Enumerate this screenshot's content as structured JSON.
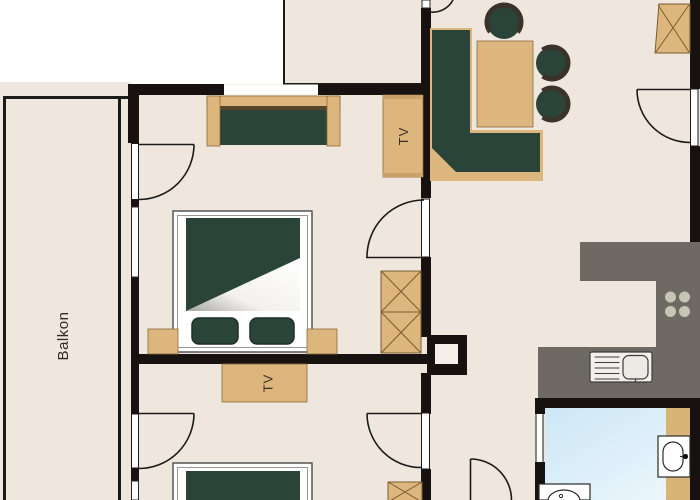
{
  "plan": {
    "type": "apartment-floorplan",
    "labels": {
      "balcony": "Balkon",
      "tv_bedroom1": "TV",
      "tv_bedroom2": "TV"
    },
    "colors": {
      "outside": "#ffffff",
      "floor": "#efe7de",
      "wall": "#171210",
      "furniture_tan": "#dcb67c",
      "furniture_tan_dark": "#c9a265",
      "furniture_green": "#2b4439",
      "furniture_green_dark": "#1d2f27",
      "ring_brown": "#3b332a",
      "outline_brown": "#8a6a3a",
      "kitchen_gray": "#6e6963",
      "burner_gray": "#c6c6b4",
      "bath_blue_1": "#cde7f5",
      "bath_blue_2": "#eef7fd",
      "fixture_white": "#ffffff",
      "text_dark": "#2e2a26"
    }
  }
}
